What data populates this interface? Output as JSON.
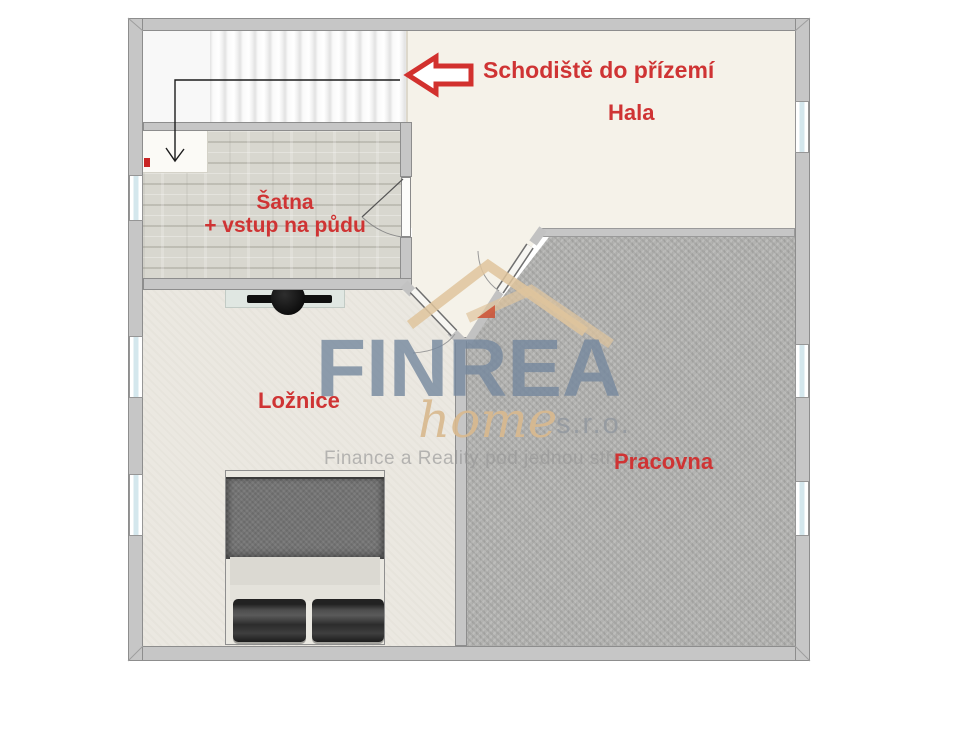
{
  "rooms": {
    "hala": {
      "label": "Hala"
    },
    "satna": {
      "label": "Šatna",
      "sublabel": "+ vstup na půdu"
    },
    "loznice": {
      "label": "Ložnice"
    },
    "pracovna": {
      "label": "Pracovna"
    }
  },
  "annotations": {
    "stair_note": "Schodiště do přízemí",
    "stair_note_arrow_icon": "left-arrow-outline",
    "stair_direction_icon": "down-arrow-line"
  },
  "watermark": {
    "brand": "FINREA",
    "brand_word2": "home",
    "brand_suffix": "s.r.o.",
    "tagline": "Finance a Reality pod jednou střechou",
    "roof_icon": "double-roof"
  },
  "colors": {
    "label_red": "#cf3434",
    "arrow_red": "#d2312e",
    "wall_gray": "#c6c6c6",
    "hala_floor": "#f5f2e9",
    "satna_wood": "#d8d7cf",
    "loznice_floor": "#ebe8e1",
    "pracovna_carpet": "#b2b2b0",
    "brand_blue": "#74879d",
    "brand_tan": "#d8b98e"
  }
}
